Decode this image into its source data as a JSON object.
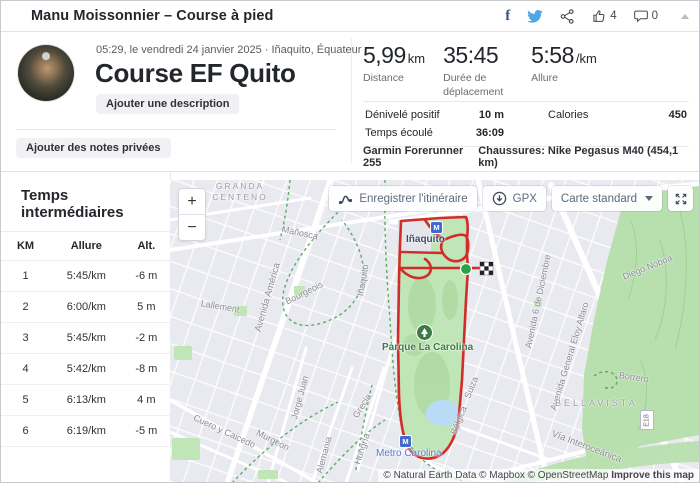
{
  "header": {
    "title": "Manu Moissonnier – Course à pied",
    "kudos_count": "4",
    "comments_count": "0"
  },
  "activity": {
    "datetime_location": "05:29, le vendredi 24 janvier 2025 · Iñaquito, Équateur",
    "title": "Course EF Quito",
    "add_description_label": "Ajouter une description",
    "add_private_notes_label": "Ajouter des notes privées"
  },
  "stats": {
    "primary": [
      {
        "value": "5,99",
        "unit": "km",
        "label": "Distance"
      },
      {
        "value": "35:45",
        "unit": "",
        "label": "Durée de déplacement"
      },
      {
        "value": "5:58",
        "unit": "/km",
        "label": "Allure"
      }
    ],
    "secondary": [
      {
        "label": "Dénivelé positif",
        "value": "10 m"
      },
      {
        "label": "Calories",
        "value": "450"
      },
      {
        "label": "Temps écoulé",
        "value": "36:09"
      }
    ],
    "device": "Garmin Forerunner 255",
    "shoes": "Chaussures: Nike Pegasus M40 (454,1 km)"
  },
  "splits": {
    "title": "Temps intermédiaires",
    "headers": [
      "KM",
      "Allure",
      "Alt."
    ],
    "rows": [
      {
        "km": "1",
        "pace": "5:45/km",
        "alt": "-6 m"
      },
      {
        "km": "2",
        "pace": "6:00/km",
        "alt": "5 m"
      },
      {
        "km": "3",
        "pace": "5:45/km",
        "alt": "-2 m"
      },
      {
        "km": "4",
        "pace": "5:42/km",
        "alt": "-8 m"
      },
      {
        "km": "5",
        "pace": "6:13/km",
        "alt": "4 m"
      },
      {
        "km": "6",
        "pace": "6:19/km",
        "alt": "-5 m"
      }
    ]
  },
  "map": {
    "controls": {
      "zoom_in": "+",
      "zoom_out": "−",
      "save_route": "Enregistrer l'itinéraire",
      "gpx": "GPX",
      "style_selector": "Carte standard"
    },
    "metro_icon_letter": "M",
    "labels": {
      "granda_centeno": "GRANDA CENTENO",
      "manosca": "Mañosca",
      "avenida_america": "Avenida América",
      "lallement": "Lallement",
      "bourgeois": "Bourgeois",
      "inaquito_street": "Iñaquito",
      "avenida_partial": "Aven",
      "inaquito_station": "Iñaquito",
      "parque_la_carolina": "Parque La Carolina",
      "avenida_6_diciembre": "Avenida 6 de Diciembre",
      "eloy_alfaro": "Avenida General Eloy Alfaro",
      "diego_noboa": "Diego Noboa",
      "borrero": "Borrero",
      "bellavista": "BELLAVISTA",
      "e18": "E18",
      "cuero_y_caicedo": "Cuero y Caicedo",
      "murgeon": "Murgeon",
      "jorge_juan": "Jorge Juan",
      "alemania": "Alemania",
      "hungria": "Hungría",
      "grecia": "Grecia",
      "suiza": "Suiza",
      "belgica": "Bélgica",
      "metro_carolina": "Metro Carolina",
      "via_interoceanica": "Vía Interoceánica"
    },
    "attribution": {
      "credits": "© Natural Earth Data © Mapbox © OpenStreetMap ",
      "improve_link": "Improve this map"
    }
  },
  "colors": {
    "route_red": "#d22b28",
    "start_green": "#2aa148",
    "facebook_navy": "#35518e",
    "twitter_blue": "#4da7e8",
    "metro_blue": "#4468cf",
    "park_green": "#c0e5b6",
    "map_button_text": "#5a6a80"
  }
}
